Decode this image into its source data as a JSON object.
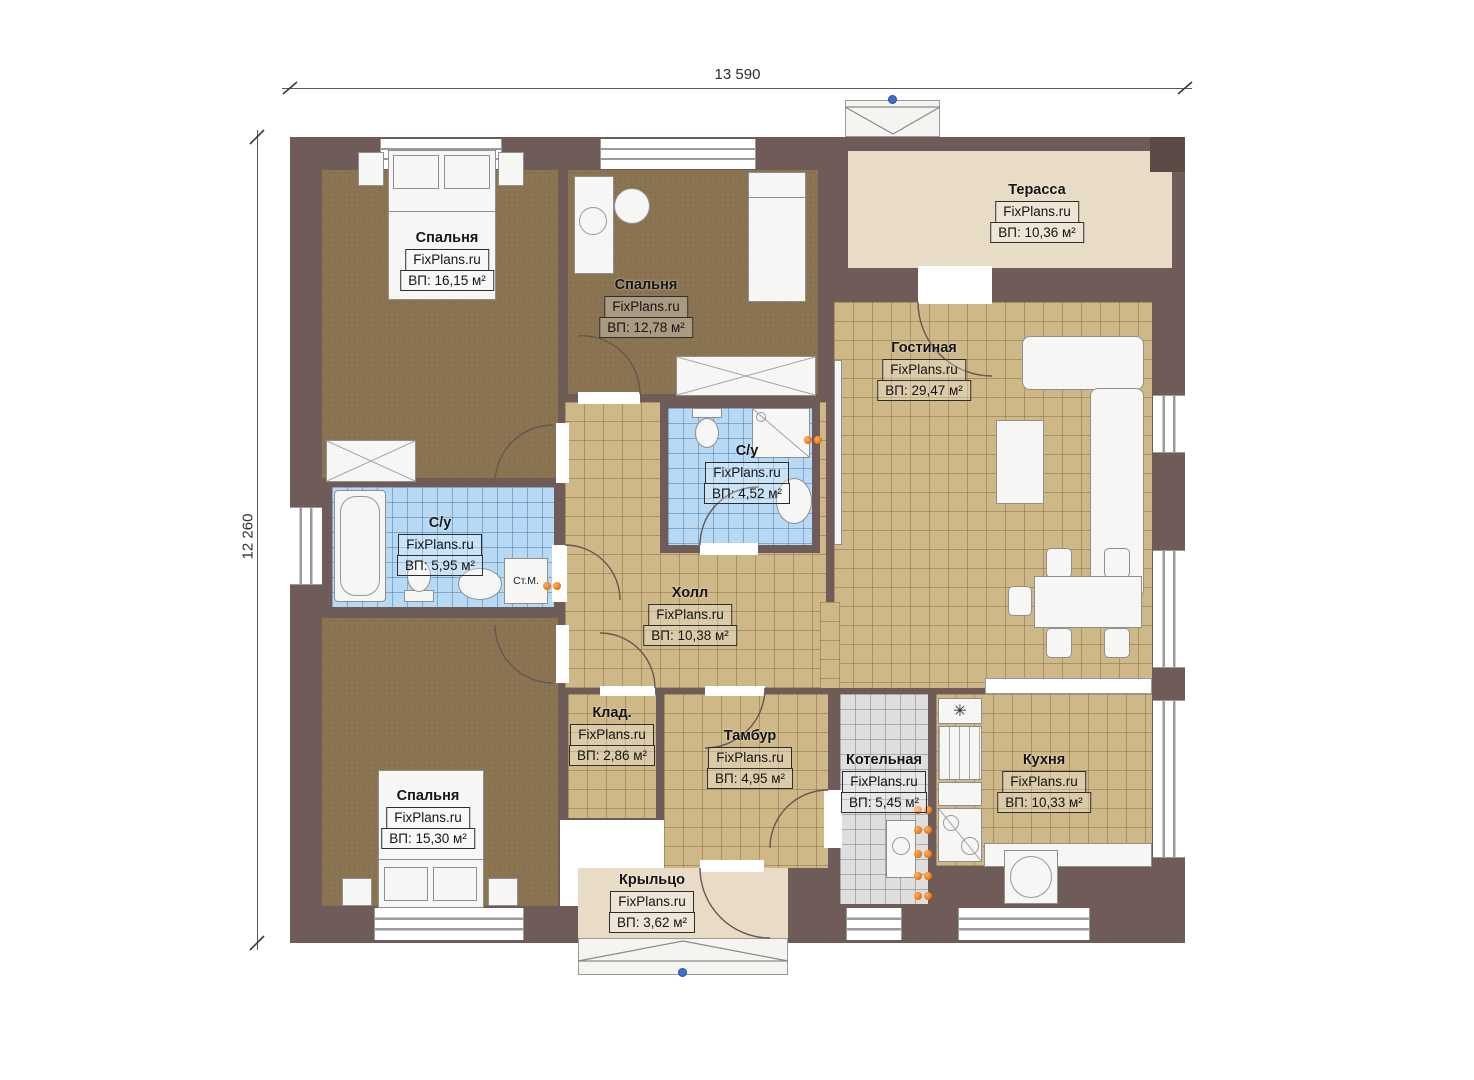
{
  "plan": {
    "dimensions": {
      "width": "13 590",
      "height": "12 260"
    },
    "rooms": [
      {
        "id": "bedroom-1",
        "name": "Спальня",
        "watermark": "FixPlans.ru",
        "area": "ВП: 16,15 м²"
      },
      {
        "id": "bedroom-2",
        "name": "Спальня",
        "watermark": "FixPlans.ru",
        "area": "ВП: 12,78 м²"
      },
      {
        "id": "terrace",
        "name": "Терасса",
        "watermark": "FixPlans.ru",
        "area": "ВП: 10,36 м²"
      },
      {
        "id": "living-room",
        "name": "Гостиная",
        "watermark": "FixPlans.ru",
        "area": "ВП: 29,47 м²"
      },
      {
        "id": "bathroom-main",
        "name": "С/у",
        "watermark": "FixPlans.ru",
        "area": "ВП: 4,52 м²"
      },
      {
        "id": "bathroom-left",
        "name": "С/у",
        "watermark": "FixPlans.ru",
        "area": "ВП: 5,95 м²"
      },
      {
        "id": "hall",
        "name": "Холл",
        "watermark": "FixPlans.ru",
        "area": "ВП: 10,38 м²"
      },
      {
        "id": "storage",
        "name": "Клад.",
        "watermark": "FixPlans.ru",
        "area": "ВП: 2,86 м²"
      },
      {
        "id": "vestibule",
        "name": "Тамбур",
        "watermark": "FixPlans.ru",
        "area": "ВП: 4,95 м²"
      },
      {
        "id": "boiler-room",
        "name": "Котельная",
        "watermark": "FixPlans.ru",
        "area": "ВП: 5,45 м²"
      },
      {
        "id": "kitchen",
        "name": "Кухня",
        "watermark": "FixPlans.ru",
        "area": "ВП: 10,33 м²"
      },
      {
        "id": "bedroom-3",
        "name": "Спальня",
        "watermark": "FixPlans.ru",
        "area": "ВП: 15,30 м²"
      },
      {
        "id": "porch",
        "name": "Крыльцо",
        "watermark": "FixPlans.ru",
        "area": "ВП: 3,62 м²"
      }
    ],
    "annotations": {
      "washing_machine": "Ст.М.",
      "vent_symbol": "✳"
    },
    "colors": {
      "wall": "#6f5b57",
      "tile_tan": "#cfb888",
      "tile_blue": "#b8d9f3",
      "tile_gray": "#dedede",
      "carpet": "#8a7452",
      "terrace": "#e9dcc6",
      "radiator_dot": "#f07e1e",
      "marker_blue": "#3b6fd4"
    }
  }
}
